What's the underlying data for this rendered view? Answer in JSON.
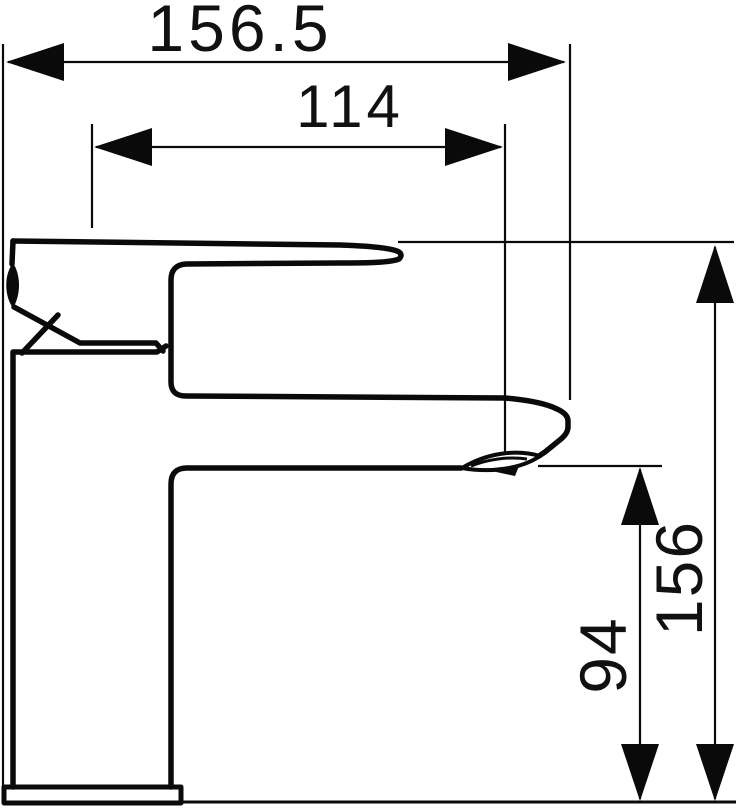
{
  "diagram": {
    "kind": "technical-dimension-drawing",
    "subject": "single-lever basin mixer faucet, side elevation",
    "background_color": "#ffffff",
    "line_color": "#0a0a0a",
    "dimensions": {
      "overall_length": {
        "label": "156.5",
        "orientation": "horizontal"
      },
      "spout_reach": {
        "label": "114",
        "orientation": "horizontal"
      },
      "overall_height": {
        "label": "156",
        "orientation": "vertical"
      },
      "outlet_height": {
        "label": "94",
        "orientation": "vertical"
      }
    }
  }
}
